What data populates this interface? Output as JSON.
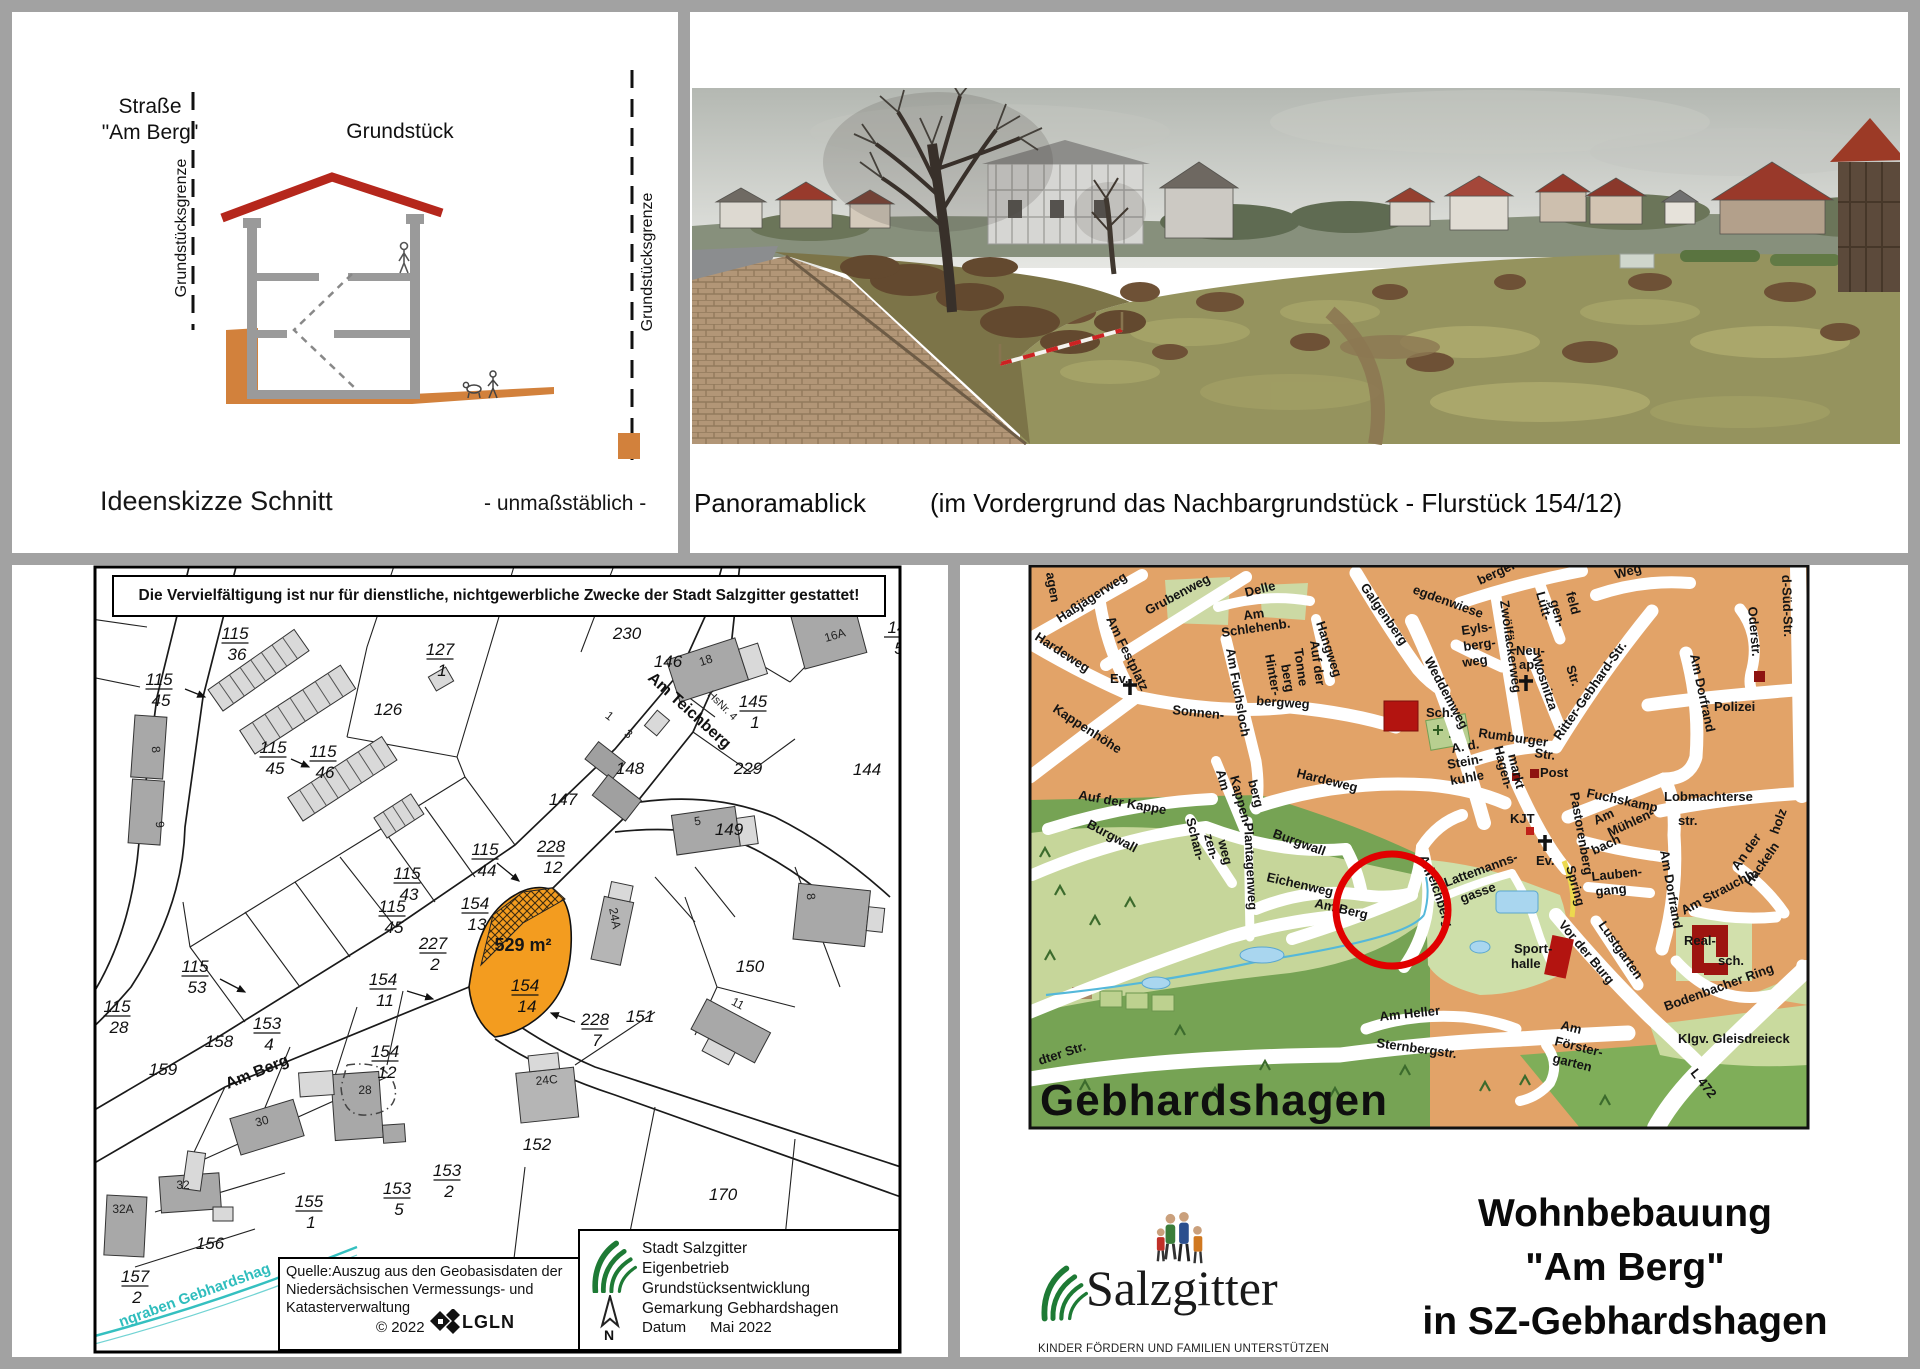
{
  "sketch": {
    "street_line1": "Straße",
    "street_line2": "\"Am Berg\"",
    "boundary_left": "Grundstücksgrenze",
    "boundary_right": "Grundstücksgrenze",
    "plot_label": "Grundstück",
    "caption": "Ideenskizze Schnitt",
    "scale_note": "- unmaßstäblich -"
  },
  "panorama": {
    "caption": "Panoramablick",
    "caption_detail": "(im Vordergrund das Nachbargrundstück - Flurstück 154/12)"
  },
  "cadastral": {
    "notice": "Die Vervielfältigung ist nur für dienstliche, nichtgewerbliche Zwecke der Stadt Salzgitter gestattet!",
    "area_label": {
      "t": "529 m²",
      "x": 428,
      "y": 384,
      "cls": "cad-area",
      "anchor": "middle"
    },
    "fractions": [
      {
        "top": "115",
        "bot": "36",
        "x": 140,
        "y": 72
      },
      {
        "top": "127",
        "bot": "1",
        "x": 345,
        "y": 88
      },
      {
        "top": "145",
        "bot": "1",
        "x": 658,
        "y": 140
      },
      {
        "top": "115",
        "bot": "45",
        "x": 64,
        "y": 118
      },
      {
        "top": "115",
        "bot": "45",
        "x": 178,
        "y": 186
      },
      {
        "top": "115",
        "bot": "46",
        "x": 228,
        "y": 190
      },
      {
        "top": "228",
        "bot": "12",
        "x": 456,
        "y": 285
      },
      {
        "top": "115",
        "bot": "44",
        "x": 390,
        "y": 288
      },
      {
        "top": "115",
        "bot": "43",
        "x": 312,
        "y": 312
      },
      {
        "top": "115",
        "bot": "45",
        "x": 297,
        "y": 345
      },
      {
        "top": "154",
        "bot": "13",
        "x": 380,
        "y": 342
      },
      {
        "top": "227",
        "bot": "2",
        "x": 338,
        "y": 382
      },
      {
        "top": "154",
        "bot": "14",
        "x": 430,
        "y": 424
      },
      {
        "top": "154",
        "bot": "11",
        "x": 288,
        "y": 418
      },
      {
        "top": "228",
        "bot": "7",
        "x": 500,
        "y": 458
      },
      {
        "top": "115",
        "bot": "53",
        "x": 100,
        "y": 405
      },
      {
        "top": "115",
        "bot": "28",
        "x": 22,
        "y": 445
      },
      {
        "top": "153",
        "bot": "4",
        "x": 172,
        "y": 462
      },
      {
        "top": "154",
        "bot": "12",
        "x": 290,
        "y": 490
      },
      {
        "top": "155",
        "bot": "1",
        "x": 214,
        "y": 640
      },
      {
        "top": "153",
        "bot": "5",
        "x": 302,
        "y": 627
      },
      {
        "top": "153",
        "bot": "2",
        "x": 352,
        "y": 609
      },
      {
        "top": "157",
        "bot": "2",
        "x": 40,
        "y": 715
      },
      {
        "top": "14",
        "bot": "5",
        "x": 802,
        "y": 66
      }
    ],
    "numbers": [
      {
        "t": "230",
        "x": 532,
        "y": 72
      },
      {
        "t": "146",
        "x": 573,
        "y": 100
      },
      {
        "t": "126",
        "x": 293,
        "y": 148
      },
      {
        "t": "148",
        "x": 535,
        "y": 207
      },
      {
        "t": "229",
        "x": 653,
        "y": 207
      },
      {
        "t": "144",
        "x": 772,
        "y": 208
      },
      {
        "t": "147",
        "x": 468,
        "y": 238
      },
      {
        "t": "149",
        "x": 634,
        "y": 268
      },
      {
        "t": "151",
        "x": 545,
        "y": 455
      },
      {
        "t": "150",
        "x": 655,
        "y": 405
      },
      {
        "t": "158",
        "x": 124,
        "y": 480
      },
      {
        "t": "159",
        "x": 68,
        "y": 508
      },
      {
        "t": "152",
        "x": 442,
        "y": 583
      },
      {
        "t": "170",
        "x": 628,
        "y": 633
      },
      {
        "t": "156",
        "x": 115,
        "y": 682
      },
      {
        "t": "8",
        "x": 57,
        "y": 183,
        "r": 84,
        "cls": "cad-b"
      },
      {
        "t": "9",
        "x": 61,
        "y": 258,
        "r": 84,
        "cls": "cad-b"
      },
      {
        "t": "18",
        "x": 612,
        "y": 97,
        "r": -18,
        "cls": "cad-b"
      },
      {
        "t": "16A",
        "x": 741,
        "y": 72,
        "r": -16,
        "cls": "cad-b"
      },
      {
        "t": "1",
        "x": 512,
        "y": 152,
        "r": 38,
        "cls": "cad-b"
      },
      {
        "t": "3",
        "x": 531,
        "y": 170,
        "r": 38,
        "cls": "cad-b"
      },
      {
        "t": "5",
        "x": 603,
        "y": 258,
        "r": -8,
        "cls": "cad-b"
      },
      {
        "t": "24A",
        "x": 516,
        "y": 352,
        "r": 80,
        "cls": "cad-b"
      },
      {
        "t": "24C",
        "x": 452,
        "y": 517,
        "r": -5,
        "cls": "cad-b"
      },
      {
        "t": "30",
        "x": 168,
        "y": 558,
        "r": -15,
        "cls": "cad-b"
      },
      {
        "t": "28",
        "x": 270,
        "y": 527,
        "cls": "cad-b"
      },
      {
        "t": "32",
        "x": 88,
        "y": 622,
        "cls": "cad-b"
      },
      {
        "t": "32A",
        "x": 28,
        "y": 646,
        "cls": "cad-b"
      },
      {
        "t": "11",
        "x": 641,
        "y": 440,
        "r": 28,
        "cls": "cad-b"
      },
      {
        "t": "8",
        "x": 712,
        "y": 330,
        "r": 84,
        "cls": "cad-b"
      }
    ],
    "streets": [
      {
        "t": "Am Berg",
        "x": 133,
        "y": 522,
        "r": -22,
        "cls": "cad-street"
      },
      {
        "t": "Am Teichberg",
        "x": 552,
        "y": 112,
        "r": 42,
        "cls": "cad-street",
        "s": 17
      },
      {
        "t": "HsNr. 4",
        "x": 612,
        "y": 128,
        "r": 45,
        "cls": "cad-small"
      },
      {
        "t": "ngraben Gebhardshag",
        "x": 26,
        "y": 760,
        "r": -20,
        "cls": "cad-water"
      }
    ],
    "source_box": {
      "l1": "Quelle:Auszug aus den Geobasisdaten der",
      "l2": "Niedersächsischen Vermessungs- und",
      "l3": "Katasterverwaltung",
      "copyright": "© 2022",
      "lgln": "LGLN"
    },
    "agency_box": {
      "l1": "Stadt Salzgitter",
      "l2": "Eigenbetrieb Grundstücksentwicklung",
      "l3": "Gemarkung Gebhardshagen",
      "datum_label": "Datum",
      "datum_value": "Mai 2022",
      "north": "N"
    }
  },
  "citymap": {
    "circle_color": "#e10000",
    "labels": [
      {
        "t": "agen",
        "x": 86,
        "y": 8,
        "r": 80,
        "s": 12
      },
      {
        "t": "Haßjägerweg",
        "x": 100,
        "y": 58,
        "r": -33
      },
      {
        "t": "Grubenweg",
        "x": 188,
        "y": 50,
        "r": -28,
        "s": 14
      },
      {
        "t": "Delle",
        "x": 286,
        "y": 32,
        "r": -14,
        "s": 15
      },
      {
        "t": "Am",
        "x": 284,
        "y": 55,
        "r": -8
      },
      {
        "t": "Schlehenb.",
        "x": 262,
        "y": 72,
        "r": -8
      },
      {
        "t": "Am Festplatz",
        "x": 146,
        "y": 54,
        "r": 64
      },
      {
        "t": "Hangweg",
        "x": 356,
        "y": 58,
        "r": 72
      },
      {
        "t": "Galgenberg",
        "x": 400,
        "y": 22,
        "r": 55,
        "s": 16
      },
      {
        "t": "Hardeweg",
        "x": 74,
        "y": 74,
        "r": 33
      },
      {
        "t": "Ev.",
        "x": 150,
        "y": 118,
        "s": 14
      },
      {
        "t": "Sonnen-",
        "x": 212,
        "y": 149,
        "r": 6
      },
      {
        "t": "bergweg",
        "x": 296,
        "y": 140,
        "r": 4
      },
      {
        "t": "Am Fuchsloch",
        "x": 266,
        "y": 84,
        "r": 80
      },
      {
        "t": "Hinter-",
        "x": 305,
        "y": 90,
        "r": 80
      },
      {
        "t": "berg",
        "x": 321,
        "y": 100,
        "r": 80
      },
      {
        "t": "Tonne",
        "x": 334,
        "y": 84,
        "r": 82
      },
      {
        "t": "Auf der",
        "x": 350,
        "y": 76,
        "r": 82
      },
      {
        "t": "Sch.",
        "x": 466,
        "y": 152,
        "s": 15
      },
      {
        "t": "A. d.",
        "x": 492,
        "y": 188,
        "r": -10
      },
      {
        "t": "Stein-",
        "x": 488,
        "y": 204,
        "r": -10
      },
      {
        "t": "kuhle",
        "x": 491,
        "y": 220,
        "r": -10
      },
      {
        "t": "Kappenhöhe",
        "x": 92,
        "y": 146,
        "r": 33,
        "s": 15
      },
      {
        "t": "Auf der Kappe",
        "x": 118,
        "y": 234,
        "r": 10,
        "s": 16
      },
      {
        "t": "Burgwall",
        "x": 126,
        "y": 262,
        "r": 28,
        "s": 15
      },
      {
        "t": "Hardeweg",
        "x": 336,
        "y": 212,
        "r": 14,
        "s": 15
      },
      {
        "t": "Am",
        "x": 256,
        "y": 206,
        "r": 75
      },
      {
        "t": "Kappen-",
        "x": 270,
        "y": 212,
        "r": 75
      },
      {
        "t": "berg",
        "x": 288,
        "y": 216,
        "r": 75
      },
      {
        "t": "Schan-",
        "x": 226,
        "y": 254,
        "r": 76
      },
      {
        "t": "zen-",
        "x": 244,
        "y": 270,
        "r": 76
      },
      {
        "t": "weg",
        "x": 258,
        "y": 276,
        "r": 76
      },
      {
        "t": "Plantagenweg",
        "x": 284,
        "y": 258,
        "r": 87
      },
      {
        "t": "Burgwall",
        "x": 312,
        "y": 272,
        "r": 20,
        "s": 15
      },
      {
        "t": "Eichenweg",
        "x": 306,
        "y": 316,
        "r": 13,
        "s": 15
      },
      {
        "t": "Am Berg",
        "x": 354,
        "y": 342,
        "r": 13,
        "s": 15
      },
      {
        "t": "Am",
        "x": 459,
        "y": 292,
        "r": 70
      },
      {
        "t": "Teichberg",
        "x": 466,
        "y": 305,
        "r": 72
      },
      {
        "t": "Lattemanns-",
        "x": 486,
        "y": 322,
        "r": -20
      },
      {
        "t": "gasse",
        "x": 502,
        "y": 338,
        "r": -20
      },
      {
        "t": "egdenwiese",
        "x": 452,
        "y": 28,
        "r": 20,
        "s": 15
      },
      {
        "t": "berger Str.",
        "x": 520,
        "y": 20,
        "r": -25,
        "s": 15
      },
      {
        "t": "Weg",
        "x": 656,
        "y": 14,
        "r": -15,
        "s": 15
      },
      {
        "t": "Weddemweg",
        "x": 464,
        "y": 95,
        "r": 62,
        "s": 17
      },
      {
        "t": "Eyls-",
        "x": 502,
        "y": 70,
        "r": -8
      },
      {
        "t": "berg-",
        "x": 504,
        "y": 86,
        "r": -8
      },
      {
        "t": "weg",
        "x": 503,
        "y": 102,
        "r": -8
      },
      {
        "t": "Zwölfäckerweg",
        "x": 540,
        "y": 36,
        "r": 82
      },
      {
        "t": "Lütt-",
        "x": 576,
        "y": 28,
        "r": 75
      },
      {
        "t": "gen-",
        "x": 590,
        "y": 36,
        "r": 75
      },
      {
        "t": "feld",
        "x": 606,
        "y": 28,
        "r": 75
      },
      {
        "t": "Neu-",
        "x": 556,
        "y": 90
      },
      {
        "t": "ap.",
        "x": 559,
        "y": 104
      },
      {
        "t": "Wosnitza",
        "x": 572,
        "y": 92,
        "r": 72
      },
      {
        "t": "Str.",
        "x": 606,
        "y": 102,
        "r": 72
      },
      {
        "t": "Ritter-Gebhard-Str.",
        "x": 600,
        "y": 176,
        "r": -55,
        "s": 15
      },
      {
        "t": "Rumburger",
        "x": 518,
        "y": 172,
        "r": 8,
        "s": 15
      },
      {
        "t": "Str.",
        "x": 574,
        "y": 192,
        "r": 8,
        "s": 15
      },
      {
        "t": "Hagen-",
        "x": 534,
        "y": 182,
        "r": 76
      },
      {
        "t": "markt",
        "x": 548,
        "y": 190,
        "r": 76
      },
      {
        "t": "Post",
        "x": 580,
        "y": 212,
        "s": 14
      },
      {
        "t": "KJT",
        "x": 550,
        "y": 258,
        "s": 14
      },
      {
        "t": "Fuchskamp",
        "x": 626,
        "y": 232,
        "r": 12,
        "s": 15
      },
      {
        "t": "Am Dorfrand",
        "x": 730,
        "y": 90,
        "r": 78,
        "s": 15
      },
      {
        "t": "Polizei",
        "x": 754,
        "y": 146,
        "s": 15
      },
      {
        "t": "Oderstr.",
        "x": 788,
        "y": 42,
        "r": 85
      },
      {
        "t": "d-Süd-Str.",
        "x": 822,
        "y": 10,
        "r": 88,
        "s": 18
      },
      {
        "t": "Lobmachterse",
        "x": 704,
        "y": 236,
        "s": 16
      },
      {
        "t": "str.",
        "x": 718,
        "y": 260,
        "s": 16
      },
      {
        "t": "Pastorenberg",
        "x": 610,
        "y": 228,
        "r": 80
      },
      {
        "t": "Spring",
        "x": 606,
        "y": 302,
        "r": 75,
        "s": 14
      },
      {
        "t": "Am",
        "x": 636,
        "y": 260,
        "r": -25
      },
      {
        "t": "Mühlen-",
        "x": 650,
        "y": 272,
        "r": -25
      },
      {
        "t": "bach",
        "x": 634,
        "y": 290,
        "r": -25
      },
      {
        "t": "Lauben-",
        "x": 632,
        "y": 316,
        "r": -6
      },
      {
        "t": "gang",
        "x": 636,
        "y": 331,
        "r": -6
      },
      {
        "t": "Lustgarten",
        "x": 638,
        "y": 360,
        "r": 55,
        "s": 15
      },
      {
        "t": "Am Dorfrand",
        "x": 700,
        "y": 286,
        "r": 80,
        "s": 16
      },
      {
        "t": "Am Strauchh.",
        "x": 724,
        "y": 350,
        "r": -28,
        "s": 14
      },
      {
        "t": "An der",
        "x": 778,
        "y": 306,
        "r": -55,
        "s": 14
      },
      {
        "t": "Hackeln",
        "x": 791,
        "y": 322,
        "r": -55,
        "s": 14
      },
      {
        "t": "holz",
        "x": 818,
        "y": 270,
        "r": -70,
        "s": 14
      },
      {
        "t": "Real-",
        "x": 724,
        "y": 380,
        "s": 15
      },
      {
        "t": "sch.",
        "x": 758,
        "y": 400,
        "s": 15
      },
      {
        "t": "Bodenbacher Ring",
        "x": 706,
        "y": 446,
        "r": -20,
        "s": 15
      },
      {
        "t": "Klgv. Gleisdreieck",
        "x": 718,
        "y": 478,
        "s": 15
      },
      {
        "t": "L 472",
        "x": 730,
        "y": 508,
        "r": 52,
        "s": 17
      },
      {
        "t": "Vor der Burg",
        "x": 598,
        "y": 360,
        "r": 50,
        "s": 17
      },
      {
        "t": "Sport-",
        "x": 554,
        "y": 388
      },
      {
        "t": "halle",
        "x": 551,
        "y": 403
      },
      {
        "t": "Ev.",
        "x": 576,
        "y": 300,
        "s": 13
      },
      {
        "t": "Am Heller",
        "x": 420,
        "y": 456,
        "r": -6,
        "s": 15
      },
      {
        "t": "Sternbergstr.",
        "x": 416,
        "y": 482,
        "r": 8,
        "s": 16
      },
      {
        "t": "Am",
        "x": 600,
        "y": 464,
        "r": 14
      },
      {
        "t": "Förster-",
        "x": 594,
        "y": 480,
        "r": 14
      },
      {
        "t": "garten",
        "x": 592,
        "y": 497,
        "r": 14
      },
      {
        "t": "dter Str.",
        "x": 80,
        "y": 500,
        "r": -18,
        "s": 15
      },
      {
        "t": "Gebhardshagen",
        "x": 80,
        "y": 550,
        "cls": "cm-town"
      }
    ]
  },
  "footer": {
    "brand": "Salzgitter",
    "tagline": "KINDER FÖRDERN UND FAMILIEN UNTERSTÜTZEN",
    "title_l1": "Wohnbebauung",
    "title_l2": "\"Am Berg\"",
    "title_l3": "in SZ-Gebhardshagen"
  }
}
